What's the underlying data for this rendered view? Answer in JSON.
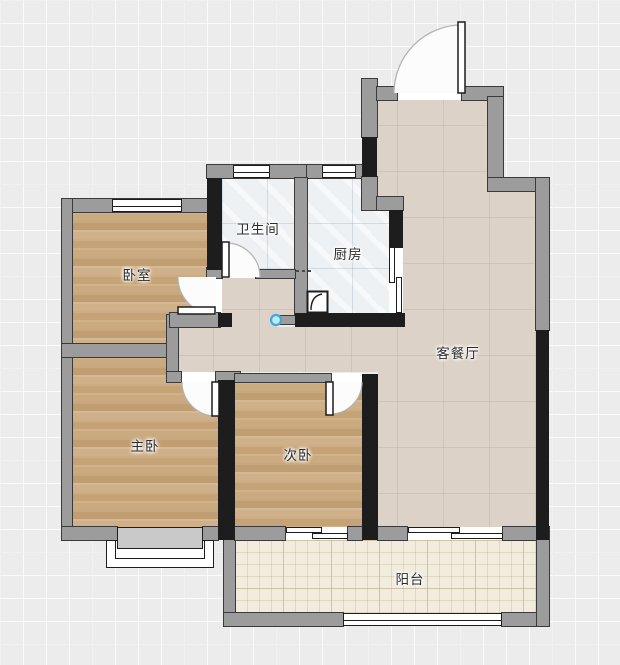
{
  "floorplan": {
    "rooms": [
      {
        "id": "bedroom",
        "label": "卧室"
      },
      {
        "id": "bathroom",
        "label": "卫生间"
      },
      {
        "id": "kitchen",
        "label": "厨房"
      },
      {
        "id": "living-dining",
        "label": "客餐厅"
      },
      {
        "id": "master-bedroom",
        "label": "主卧"
      },
      {
        "id": "second-bedroom",
        "label": "次卧"
      },
      {
        "id": "balcony",
        "label": "阳台"
      }
    ],
    "icons": [
      {
        "id": "point-marker",
        "name": "blue-point-marker-icon"
      },
      {
        "id": "sink",
        "name": "kitchen-sink-icon"
      }
    ],
    "colors": {
      "background": "#ececec",
      "wall_gray": "#9c9c9c",
      "wall_black": "#1d1d1d",
      "wood_floor": "#c9a87c",
      "tile_floor": "#eef1f3",
      "hall_floor": "#dcd2c7",
      "balcony_floor": "#f1ecdd",
      "marker_blue": "#41a8dc"
    }
  }
}
